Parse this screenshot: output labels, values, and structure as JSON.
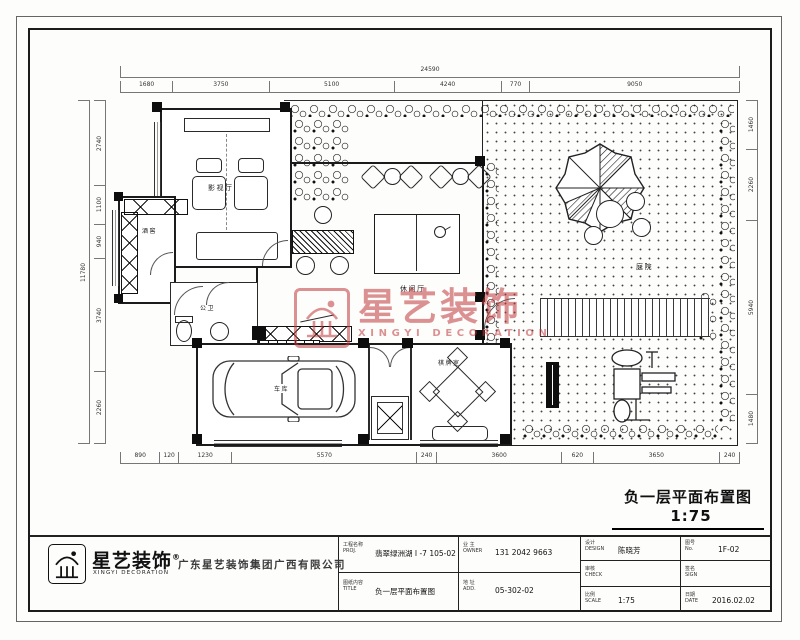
{
  "sheet": {
    "title": "负一层平面布置图",
    "scale": "1:75"
  },
  "watermark": {
    "cn": "星艺装饰",
    "en": "XINGYI DECORATION",
    "color": "#c0393b"
  },
  "plan": {
    "rooms": {
      "media": "影视厅",
      "cellar": "酒窖",
      "bath": "公卫",
      "lounge": "休闲厅",
      "garage": "车库",
      "chess": "棋牌室",
      "yard": "庭院",
      "stair_note": "下"
    },
    "dims": {
      "top_overall": [
        "24590"
      ],
      "top": [
        "1680",
        "3750",
        "5100",
        "4240",
        "770",
        "9050"
      ],
      "bottom": [
        "890",
        "120",
        "1230",
        "5570",
        "240",
        "3600",
        "620",
        "3650",
        "240"
      ],
      "left_overall": [
        "11780"
      ],
      "left": [
        "2740",
        "1100",
        "940",
        "3740",
        "2260"
      ],
      "right": [
        "1460",
        "2260",
        "5940",
        "1480"
      ]
    }
  },
  "titleblock": {
    "logo_cn": "星艺装饰",
    "logo_reg": "®",
    "logo_en": "XINGYI DECORATION",
    "company": "广东星艺装饰集团广西有限公司",
    "cells": [
      {
        "label": "工程名称",
        "sub": "PROJ.",
        "value": "翡翠绿洲湖 I -7 105-02"
      },
      {
        "label": "图纸内容",
        "sub": "TITLE",
        "value": "负一层平面布置图"
      },
      {
        "label": "业 主",
        "sub": "OWNER",
        "value": "131 2042 9663"
      },
      {
        "label": "地 址",
        "sub": "ADD.",
        "value": "05-302-02"
      },
      {
        "label": "设计",
        "sub": "DESIGN",
        "value": "陈晓芳"
      },
      {
        "label": "审核",
        "sub": "CHECK",
        "value": ""
      },
      {
        "label": "比例",
        "sub": "SCALE",
        "value": "1:75"
      },
      {
        "label": "图号",
        "sub": "No.",
        "value": "1F-02"
      },
      {
        "label": "签名",
        "sub": "SIGN",
        "value": ""
      },
      {
        "label": "日期",
        "sub": "DATE",
        "value": "2016.02.02"
      }
    ]
  }
}
